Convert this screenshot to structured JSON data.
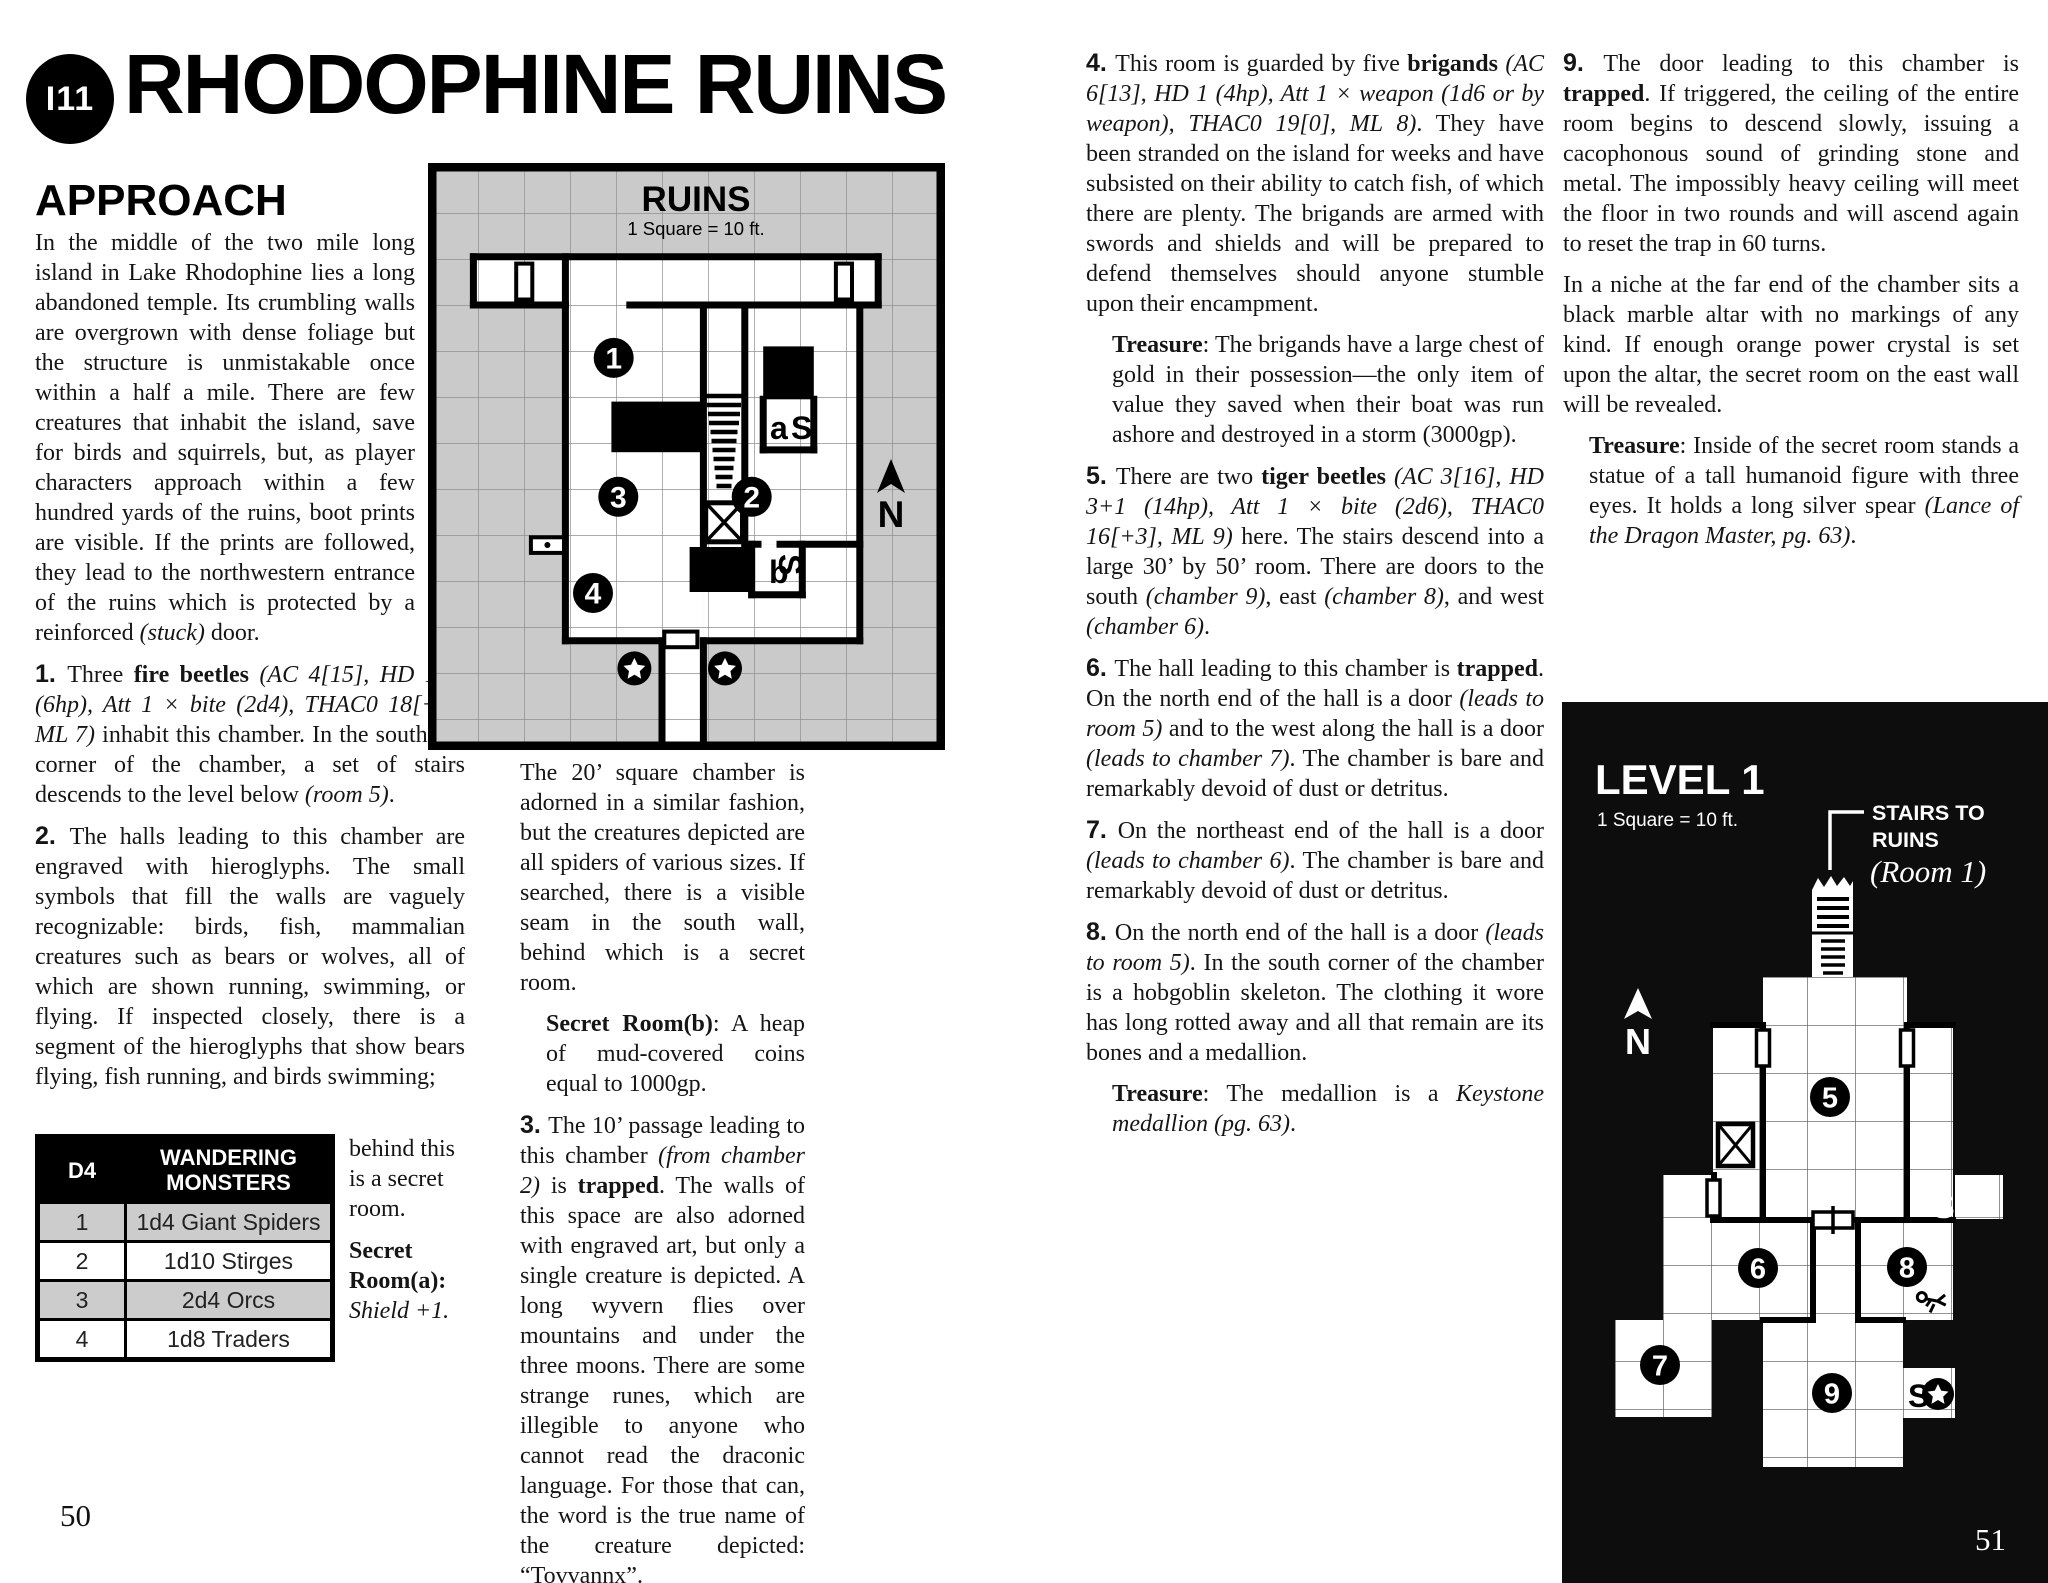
{
  "header": {
    "badge": "I11",
    "title": "RHODOPHINE RUINS"
  },
  "approach": {
    "heading": "APPROACH"
  },
  "page_numbers": {
    "left": "50",
    "right": "51"
  },
  "columns": {
    "col1_approach": [
      {
        "cls": "narrow",
        "segs": [
          {
            "t": "In the middle of the two mile long island in Lake Rhodophine lies a long abandoned temple. Its crumbling walls are overgrown with dense foliage but the structure is unmistakable once within a half a mile. There are few creatures that inhabit the island, save for birds and squirrels, but, as player characters approach within a few hundred yards of the ruins, boot prints are visible. If the prints are followed, they lead to the northwestern entrance of the ruins which is protected by a reinforced ",
            "s": "n"
          },
          {
            "t": "(stuck)",
            "s": "i"
          },
          {
            "t": " door.",
            "s": "n"
          }
        ]
      }
    ],
    "col1_entries": [
      {
        "cls": "entry",
        "segs": [
          {
            "t": "1. ",
            "s": "num"
          },
          {
            "t": "Three ",
            "s": "n"
          },
          {
            "t": "fire beetles ",
            "s": "b"
          },
          {
            "t": "(AC 4[15], HD 1+2 (6hp), Att 1 × bite (2d4), THAC0 18[+1], ML 7)",
            "s": "i"
          },
          {
            "t": " inhabit this chamber. In the southeast corner of the chamber, a set of stairs descends to the level below ",
            "s": "n"
          },
          {
            "t": "(room 5)",
            "s": "i"
          },
          {
            "t": ".",
            "s": "n"
          }
        ]
      },
      {
        "cls": "entry",
        "segs": [
          {
            "t": "2. ",
            "s": "num"
          },
          {
            "t": "The halls leading to this chamber are engraved with hieroglyphs. The small symbols that fill the walls are vaguely recognizable: birds, fish, mammalian creatures such as bears or wolves, all of which are shown running, swimming, or flying. If inspected closely, there is a segment of the hieroglyphs that show bears flying, fish running, and birds swimming;",
            "s": "n"
          }
        ]
      }
    ],
    "col1_wrap": [
      {
        "cls": "",
        "segs": [
          {
            "t": "behind this is a secret room.",
            "s": "n"
          }
        ]
      },
      {
        "cls": "",
        "segs": [
          {
            "t": "Secret Room(a):",
            "s": "b"
          },
          {
            "t": " ",
            "s": "n"
          },
          {
            "t": "Shield +1.",
            "s": "i"
          }
        ]
      }
    ],
    "col2": [
      {
        "cls": "",
        "segs": [
          {
            "t": "The 20’ square chamber is adorned in a similar fashion, but the creatures depicted are all spiders of various sizes. If searched, there is a visible seam in the south wall, behind which is a secret room.",
            "s": "n"
          }
        ]
      },
      {
        "cls": "treasure",
        "segs": [
          {
            "t": "Secret Room(b)",
            "s": "b"
          },
          {
            "t": ": A heap of mud-covered coins equal to 1000gp.",
            "s": "n"
          }
        ]
      },
      {
        "cls": "entry",
        "segs": [
          {
            "t": "3. ",
            "s": "num"
          },
          {
            "t": "The 10’ passage leading to this chamber ",
            "s": "n"
          },
          {
            "t": "(from chamber 2)",
            "s": "i"
          },
          {
            "t": " is ",
            "s": "n"
          },
          {
            "t": "trapped",
            "s": "b"
          },
          {
            "t": ". The walls of this space are also adorned with engraved art, but only a single creature is depicted. A long wyvern flies over mountains and under the three moons. There are some strange runes, which are illegible to anyone who cannot read the draconic language. For those that can, the word is the true name of the creature depicted: “Tovvannx”.",
            "s": "n"
          }
        ]
      }
    ],
    "col3": [
      {
        "cls": "entry",
        "segs": [
          {
            "t": "4. ",
            "s": "num"
          },
          {
            "t": "This room is guarded by five ",
            "s": "n"
          },
          {
            "t": "brigands ",
            "s": "b"
          },
          {
            "t": "(AC 6[13], HD 1 (4hp), Att 1 × weapon (1d6 or by weapon), THAC0 19[0], ML 8)",
            "s": "i"
          },
          {
            "t": ". They have been stranded on the island for weeks and have subsisted on their ability to catch fish, of which there are plenty. The brigands are armed with swords and shields and will be prepared to defend themselves should anyone stumble upon their encampment.",
            "s": "n"
          }
        ]
      },
      {
        "cls": "treasure",
        "segs": [
          {
            "t": "Treasure",
            "s": "b"
          },
          {
            "t": ": The brigands have a large chest of gold in their possession—the only item of value they saved when their boat was run ashore and destroyed in a storm (3000gp).",
            "s": "n"
          }
        ]
      },
      {
        "cls": "entry",
        "segs": [
          {
            "t": "5. ",
            "s": "num"
          },
          {
            "t": "There are two ",
            "s": "n"
          },
          {
            "t": "tiger beetles ",
            "s": "b"
          },
          {
            "t": "(AC 3[16], HD 3+1 (14hp), Att 1 × bite (2d6), THAC0 16[+3], ML 9)",
            "s": "i"
          },
          {
            "t": " here. The stairs descend into a large 30’ by 50’ room. There are doors to the south ",
            "s": "n"
          },
          {
            "t": "(chamber 9)",
            "s": "i"
          },
          {
            "t": ", east ",
            "s": "n"
          },
          {
            "t": "(chamber 8)",
            "s": "i"
          },
          {
            "t": ", and west ",
            "s": "n"
          },
          {
            "t": "(chamber 6)",
            "s": "i"
          },
          {
            "t": ".",
            "s": "n"
          }
        ]
      },
      {
        "cls": "entry",
        "segs": [
          {
            "t": "6. ",
            "s": "num"
          },
          {
            "t": "The hall leading to this chamber is ",
            "s": "n"
          },
          {
            "t": "trapped",
            "s": "b"
          },
          {
            "t": ". On the north end of the hall is a door ",
            "s": "n"
          },
          {
            "t": "(leads to room 5)",
            "s": "i"
          },
          {
            "t": " and to the west along the hall is a door ",
            "s": "n"
          },
          {
            "t": "(leads to chamber 7)",
            "s": "i"
          },
          {
            "t": ". The chamber is bare and remarkably devoid of dust or detritus.",
            "s": "n"
          }
        ]
      },
      {
        "cls": "entry",
        "segs": [
          {
            "t": "7. ",
            "s": "num"
          },
          {
            "t": "On the northeast end of the hall is a door ",
            "s": "n"
          },
          {
            "t": "(leads to chamber 6)",
            "s": "i"
          },
          {
            "t": ". The chamber is bare and remarkably devoid of dust or detritus.",
            "s": "n"
          }
        ]
      },
      {
        "cls": "entry",
        "segs": [
          {
            "t": "8. ",
            "s": "num"
          },
          {
            "t": "On the north end of the hall is a door ",
            "s": "n"
          },
          {
            "t": "(leads to room 5)",
            "s": "i"
          },
          {
            "t": ". In the south corner of the chamber is a hobgoblin skeleton. The clothing it wore has long rotted away and all that remain are its bones and a medallion.",
            "s": "n"
          }
        ]
      },
      {
        "cls": "treasure",
        "segs": [
          {
            "t": "Treasure",
            "s": "b"
          },
          {
            "t": ": The medallion is a ",
            "s": "n"
          },
          {
            "t": "Keystone medallion (pg. 63)",
            "s": "i"
          },
          {
            "t": ".",
            "s": "n"
          }
        ]
      }
    ],
    "col4": [
      {
        "cls": "entry",
        "segs": [
          {
            "t": "9. ",
            "s": "num"
          },
          {
            "t": "The door leading to this chamber is ",
            "s": "n"
          },
          {
            "t": "trapped",
            "s": "b"
          },
          {
            "t": ". If triggered, the ceiling of the entire room begins to descend slowly, issuing a cacophonous sound of grinding stone and metal. The impossibly heavy ceiling will meet the floor in two rounds and will ascend again to reset the trap in 60 turns.",
            "s": "n"
          }
        ]
      },
      {
        "cls": "",
        "segs": [
          {
            "t": "In a niche at the far end of the chamber sits a black marble altar with no markings of any kind. If enough orange power crystal is set upon the altar, the secret room on the east wall will be revealed.",
            "s": "n"
          }
        ]
      },
      {
        "cls": "treasure",
        "segs": [
          {
            "t": "Treasure",
            "s": "b"
          },
          {
            "t": ": Inside of the secret room stands a statue of a tall humanoid figure with three eyes. It holds a long silver spear ",
            "s": "n"
          },
          {
            "t": "(Lance of the Dragon Master, pg. 63)",
            "s": "i"
          },
          {
            "t": ".",
            "s": "n"
          }
        ]
      }
    ]
  },
  "table": {
    "header": [
      "D4",
      "WANDERING MONSTERS"
    ],
    "rows": [
      [
        "1",
        "1d4 Giant Spiders"
      ],
      [
        "2",
        "1d10 Stirges"
      ],
      [
        "3",
        "2d4 Orcs"
      ],
      [
        "4",
        "1d8 Traders"
      ]
    ]
  },
  "maps": {
    "ruins": {
      "title": "RUINS",
      "scale": "1 Square = 10 ft.",
      "north": "N",
      "badges": [
        "1",
        "2",
        "3",
        "4"
      ],
      "label_a": "a",
      "label_s_a": "S",
      "label_s_b": "S",
      "label_b": "b"
    },
    "level1": {
      "title": "LEVEL 1",
      "scale": "1 Square = 10 ft.",
      "callout_line1": "STAIRS TO",
      "callout_line2": "RUINS",
      "callout_ref": "(Room 1)",
      "north": "N",
      "badges": [
        "5",
        "6",
        "7",
        "8",
        "9"
      ],
      "secret_right": "S",
      "secret_star": "S"
    }
  }
}
